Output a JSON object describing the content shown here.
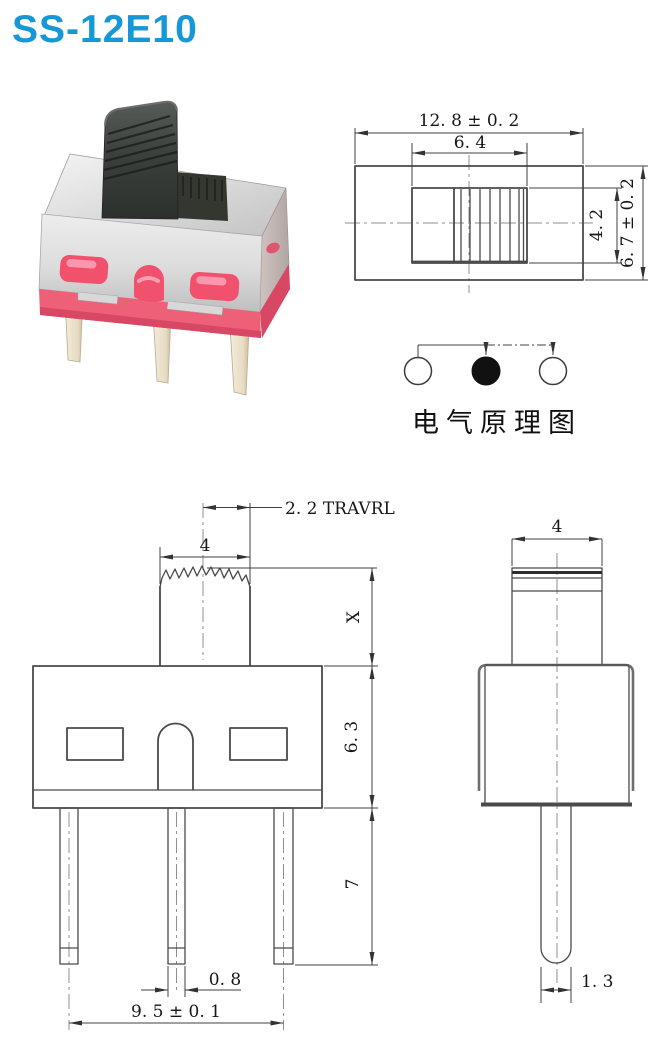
{
  "page": {
    "title": "SS-12E10",
    "background": "#ffffff"
  },
  "colors": {
    "title_blue": "#1698d6",
    "drawing_line": "#4a4a4a",
    "centerline_gray": "#8f8f8f",
    "photo_base_pink": "#ee5f78",
    "photo_window_pink": "#f2516e",
    "photo_knob_gray": "#3c403c",
    "photo_pin_cream": "#ece1cb",
    "photo_metal_silver": "#d9d9d9"
  },
  "top_view": {
    "dims": {
      "total_width": "12. 8 ± 0. 2",
      "slot_width": "6. 4",
      "slot_height": "4. 2",
      "total_height": "6. 7 ± 0. 2"
    }
  },
  "schematic": {
    "label": "电气原理图",
    "poles": [
      "open",
      "filled",
      "open"
    ]
  },
  "front_view": {
    "dims": {
      "travel": "2. 2 TRAVRL",
      "knob_width": "4",
      "knob_height": "X",
      "body_height": "6. 3",
      "pin_length": "7",
      "pin_width": "0. 8",
      "pin_span": "9. 5 ± 0. 1"
    }
  },
  "side_view": {
    "dims": {
      "knob_width": "4",
      "pin_thickness": "1. 3"
    }
  }
}
